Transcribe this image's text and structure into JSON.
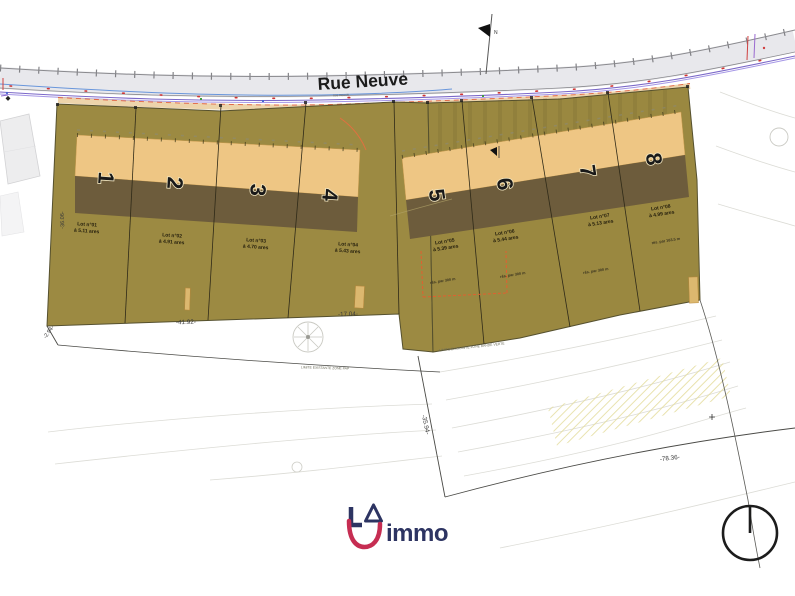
{
  "plan": {
    "road": {
      "name": "Rue Neuve",
      "name_small": "rue neuve"
    },
    "north_label": "N",
    "lots": [
      {
        "num": "1",
        "name": "Lot n°01",
        "area": "à 5.11 ares"
      },
      {
        "num": "2",
        "name": "Lot n°02",
        "area": "à 4.91 ares"
      },
      {
        "num": "3",
        "name": "Lot n°03",
        "area": "à 4.70 ares"
      },
      {
        "num": "4",
        "name": "Lot n°04",
        "area": "à 5.43 ares"
      },
      {
        "num": "5",
        "name": "Lot n°05",
        "area": "à 5.39 ares",
        "note": "rés. par 300 m"
      },
      {
        "num": "6",
        "name": "Lot n°06",
        "area": "à 5.44 ares",
        "note": "rés. par 300 m"
      },
      {
        "num": "7",
        "name": "Lot n°07",
        "area": "à 5.13 ares",
        "note": "rés. par 300 m"
      },
      {
        "num": "8",
        "name": "Lot n°08",
        "area": "à 4.99 ares",
        "note": "rés. par 163.5 m"
      }
    ],
    "dimensions": {
      "front_left": "-41.92-",
      "front_right": "-17.04-",
      "side_left": "-36.06-",
      "corner_left": "-2.94-",
      "diag_west": "-35.94-",
      "diag_south": "-78.36-"
    },
    "boundary_notes": {
      "west": "LIMITE EXISTANTE ZONE PAP",
      "east": "LIMITE EXISTANTE ZONE BANDE VERTE"
    }
  },
  "logo": {
    "wordmark": "immo"
  },
  "colors": {
    "parcel_olive": "#9c8a42",
    "building_front_tan": "#eec684",
    "building_rear_brown": "#6d5c3c",
    "road_utility_purple": "#7b68c8",
    "road_water_blue": "#5b8dd9",
    "marking_orange": "#e05838",
    "logo_navy": "#2d3462",
    "logo_red": "#c62d52"
  }
}
